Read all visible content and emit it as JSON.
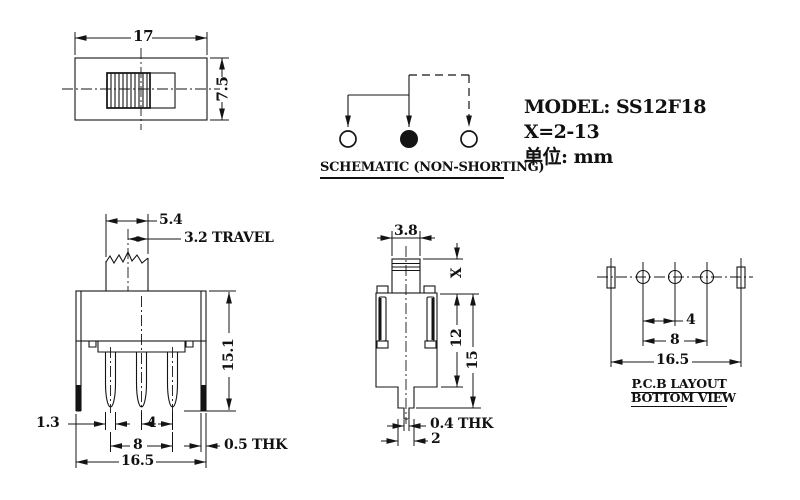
{
  "colors": {
    "ink": "#141414",
    "paper": "#ffffff"
  },
  "title_block": {
    "model": "MODEL: SS12F18",
    "x_range": "X=2-13",
    "unit": "单位: mm"
  },
  "top_view": {
    "width": "17",
    "height": "7.5"
  },
  "schematic": {
    "caption": "SCHEMATIC (NON-SHORTING)"
  },
  "front_view": {
    "knob_width": "5.4",
    "travel": "3.2 TRAVEL",
    "height": "15.1",
    "pin_width": "1.3",
    "pin_pitch": "4",
    "pin_span": "8",
    "overall_width": "16.5",
    "cover_thickness": "0.5 THK"
  },
  "side_view": {
    "knob_depth": "3.8",
    "knob_height": "X",
    "body_height": "12",
    "overall_height": "15",
    "terminal_thickness": "0.4 THK",
    "tip_width": "2"
  },
  "pcb_layout": {
    "pitch": "4",
    "span": "8",
    "overall": "16.5",
    "caption_line1": "P.C.B LAYOUT",
    "caption_line2": "BOTTOM VIEW"
  }
}
